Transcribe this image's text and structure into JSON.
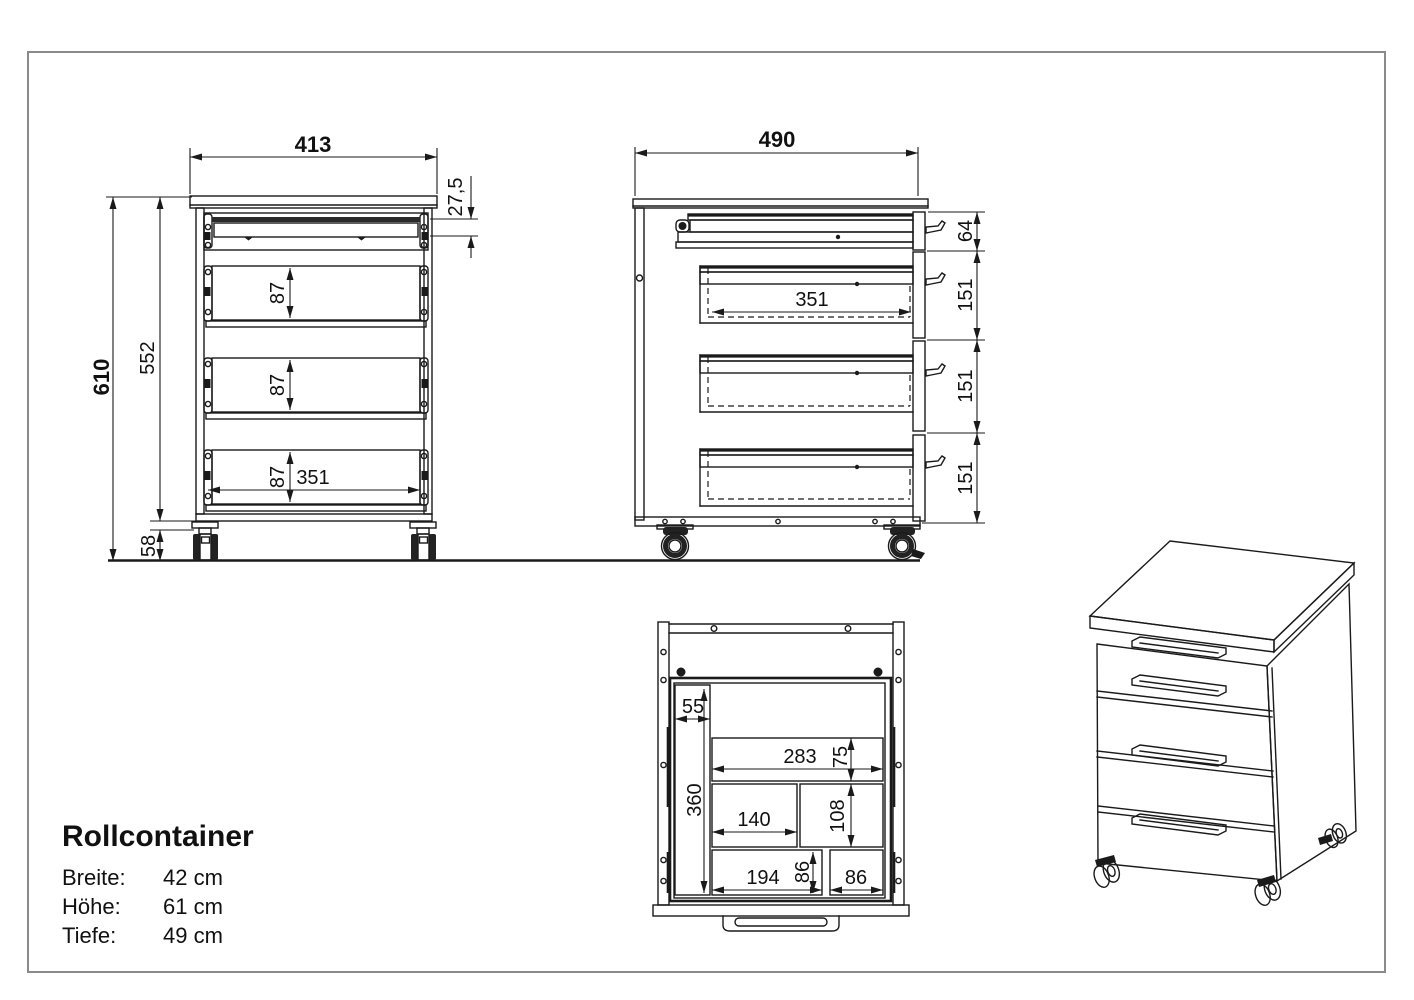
{
  "title_block": {
    "title": "Rollcontainer",
    "specs": [
      {
        "label": "Breite:",
        "value": "42 cm"
      },
      {
        "label": "Höhe:",
        "value": "61 cm"
      },
      {
        "label": "Tiefe:",
        "value": "49 cm"
      }
    ]
  },
  "front_view": {
    "width": "413",
    "height_total": "610",
    "height_body": "552",
    "caster_height": "58",
    "top_gap": "27,5",
    "drawer_front_height": "87",
    "drawer_inner_width": "351"
  },
  "side_view": {
    "depth": "490",
    "top_drawer_height": "64",
    "drawer_height": "151",
    "drawer_inner_depth": "351"
  },
  "top_view": {
    "pencil_tray_width": "55",
    "tray_depth": "360",
    "comp_top_width": "283",
    "comp_top_depth": "75",
    "comp_mid_width": "140",
    "comp_mid_depth": "108",
    "comp_bottom_width": "194",
    "comp_bottom_depth": "86",
    "comp_bottom2_width": "86"
  },
  "colors": {
    "line": "#1a1a1a",
    "frame_border": "#8a8a8a",
    "background": "#ffffff"
  }
}
